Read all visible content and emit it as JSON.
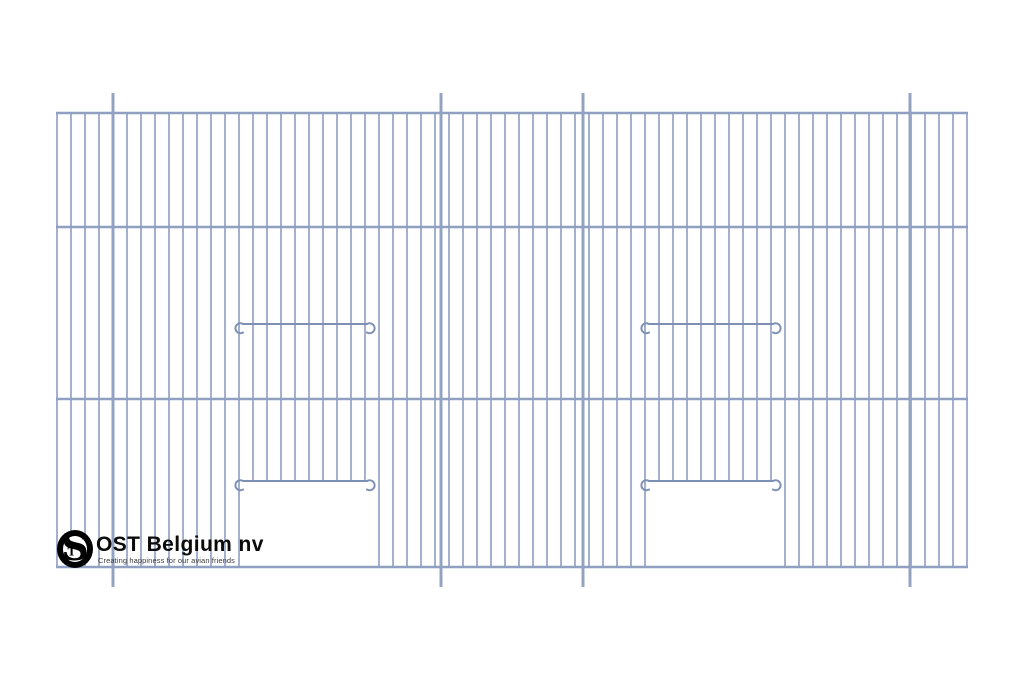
{
  "canvas": {
    "width": 1024,
    "height": 683,
    "background": "#ffffff"
  },
  "brand": {
    "name": "OST Belgium nv",
    "tagline": "Creating happiness for our avian friends",
    "monogram_s": "S",
    "monogram_t": "T"
  },
  "panel": {
    "left": 57,
    "right": 968,
    "top": 113,
    "bottom": 567,
    "bar_pitch": 14,
    "bar_count": 66,
    "horizontal_bars_y": [
      113,
      227,
      399,
      567
    ],
    "posts_x": [
      113,
      441,
      583,
      910
    ],
    "post_overhang": 20,
    "doors": [
      {
        "k1": 13,
        "k2": 23,
        "opening_top_y": 481
      },
      {
        "k1": 42,
        "k2": 52,
        "opening_top_y": 481
      }
    ],
    "rail_ys": [
      324,
      481
    ],
    "colors": {
      "bar": "#9aa8c6",
      "frame": "#8fa0c1",
      "post": "#94a3c2",
      "rail": "#7c90b5"
    }
  }
}
